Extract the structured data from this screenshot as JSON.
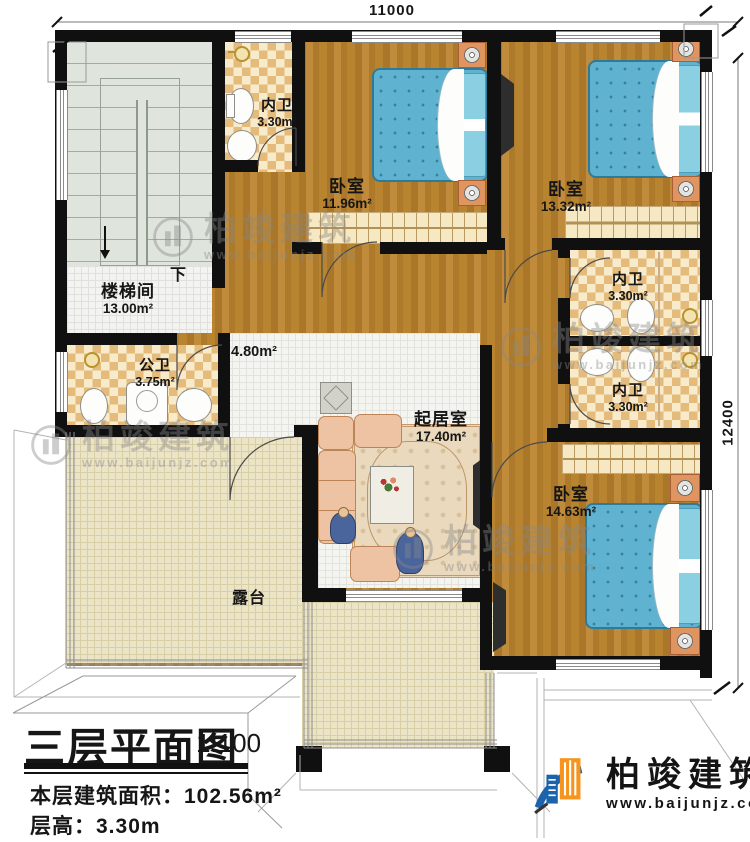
{
  "dimensions": {
    "top": "11000",
    "right": "12400"
  },
  "rooms": [
    {
      "id": "staircase",
      "name": "楼梯间",
      "area": "13.00m²"
    },
    {
      "id": "bath1",
      "name": "内卫",
      "area": "3.30m²"
    },
    {
      "id": "bedroom1",
      "name": "卧室",
      "area": "11.96m²"
    },
    {
      "id": "bedroom2",
      "name": "卧室",
      "area": "13.32m²"
    },
    {
      "id": "hall",
      "name": "",
      "area": "4.80m²"
    },
    {
      "id": "public-bath",
      "name": "公卫",
      "area": "3.75m²"
    },
    {
      "id": "bath2",
      "name": "内卫",
      "area": "3.30m²"
    },
    {
      "id": "bath3",
      "name": "内卫",
      "area": "3.30m²"
    },
    {
      "id": "living",
      "name": "起居室",
      "area": "17.40m²"
    },
    {
      "id": "bedroom3",
      "name": "卧室",
      "area": "14.63m²"
    },
    {
      "id": "terrace",
      "name": "露台",
      "area": ""
    }
  ],
  "stairs": {
    "down_label": "下"
  },
  "title_block": {
    "title": "三层平面图",
    "scale": "1:100",
    "area_label": "本层建筑面积：",
    "area_value": "102.56m²",
    "height_label": "层高：",
    "height_value": "3.30m"
  },
  "brand": {
    "name": "柏竣建筑",
    "url": "www.baijunjz.com"
  },
  "watermark": {
    "name": "柏竣建筑",
    "url": "www.baijunjz.com"
  },
  "colors": {
    "wall": "#101010",
    "wood_floor": "#b07c33",
    "bed_blue": "#5fb3d0",
    "checker_tan": "#e5bb7c",
    "terrace_beige": "#ece4c7",
    "brand_blue": "#1b64ad",
    "brand_orange": "#f7941d"
  }
}
